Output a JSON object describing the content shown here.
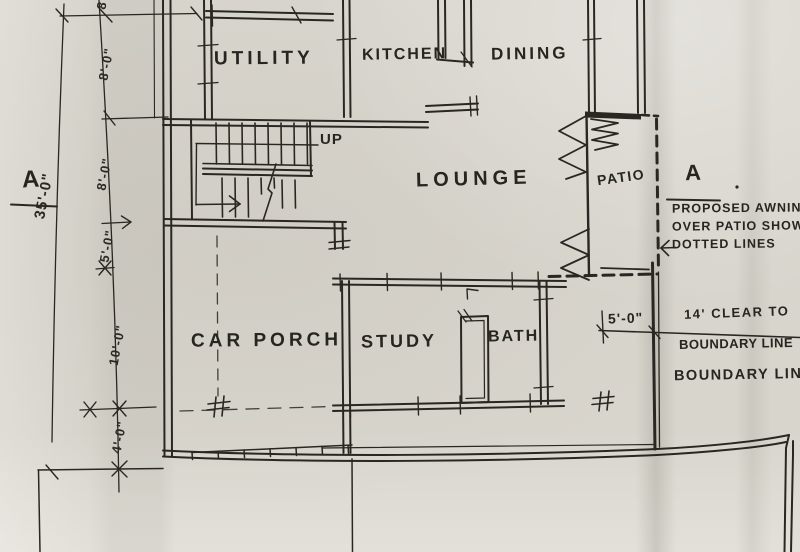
{
  "plan": {
    "rooms": {
      "utility": "UTILITY",
      "kitchen": "KITCHEN",
      "dining": "DINING",
      "lounge": "LOUNGE",
      "patio": "PATIO",
      "car_porch": "CAR PORCH",
      "study": "STUDY",
      "bath": "BATH"
    },
    "stairs": {
      "direction_label": "UP"
    }
  },
  "dimensions": {
    "left_chain": {
      "top_partial": "8'-0\"",
      "d1": "8'-0\"",
      "d2": "8'-0\"",
      "d3": "5'-0\"",
      "d4": "10'-0\"",
      "d5": "4'-0\"",
      "overall": "35'-0\""
    },
    "setback": "5'-0\""
  },
  "annotations": {
    "section_left": "A",
    "section_right": "A",
    "awning_note": [
      "PROPOSED AWNING",
      "OVER PATIO SHOWN",
      "DOTTED LINES"
    ],
    "clearance_note": [
      "14' CLEAR TO",
      "BOUNDARY LINE"
    ],
    "boundary_label": "BOUNDARY LINE"
  },
  "colors": {
    "ink": "#2a2722",
    "paper": "#d8d5cd"
  }
}
